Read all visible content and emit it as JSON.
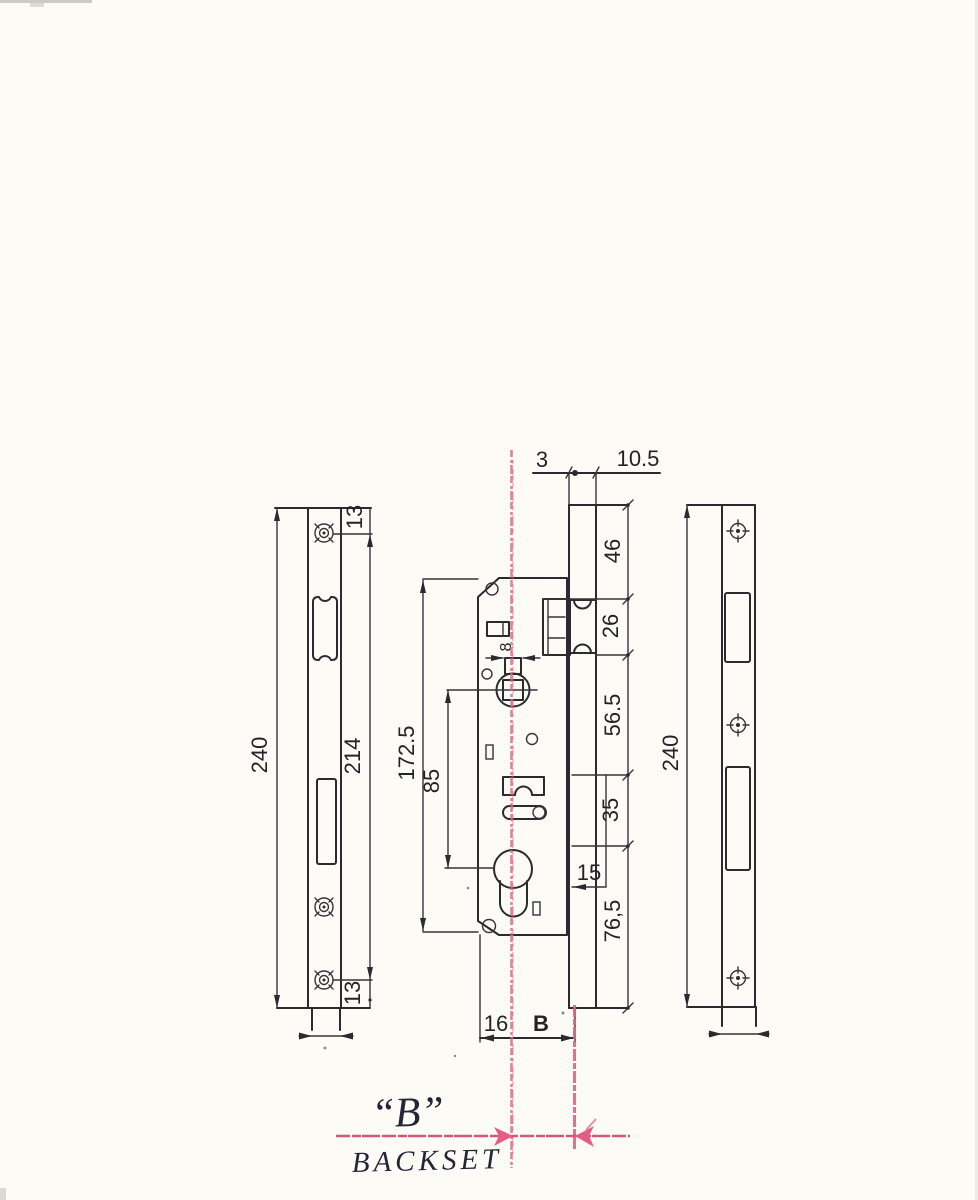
{
  "title": "Mortise lock case technical drawing with backset annotation",
  "colors": {
    "paper": "#fcfbf6",
    "ink": "#2a2a30",
    "pink_annotation": "#d96483",
    "handwriting_ink": "#252538"
  },
  "labels": {
    "left_plate": {
      "length": "240",
      "screw_span": "214",
      "screw_inset_top": "13",
      "screw_inset_bottom": "13"
    },
    "top": {
      "front_offset": "3",
      "back_offset": "10.5"
    },
    "body": {
      "case_height": "172.5",
      "axis_span": "85",
      "spindle_square": "8"
    },
    "right_chain": {
      "seg_46": "46",
      "seg_26": "26",
      "seg_56": "56.5",
      "seg_35": "35",
      "seg_15": "15",
      "seg_76": "76,5"
    },
    "bottom": {
      "edge_to_axis": "16",
      "backset_var": "B"
    },
    "right_plate": {
      "length": "240"
    },
    "handwritten": {
      "b_quoted": "“B”",
      "backset": "BACKSET"
    }
  }
}
